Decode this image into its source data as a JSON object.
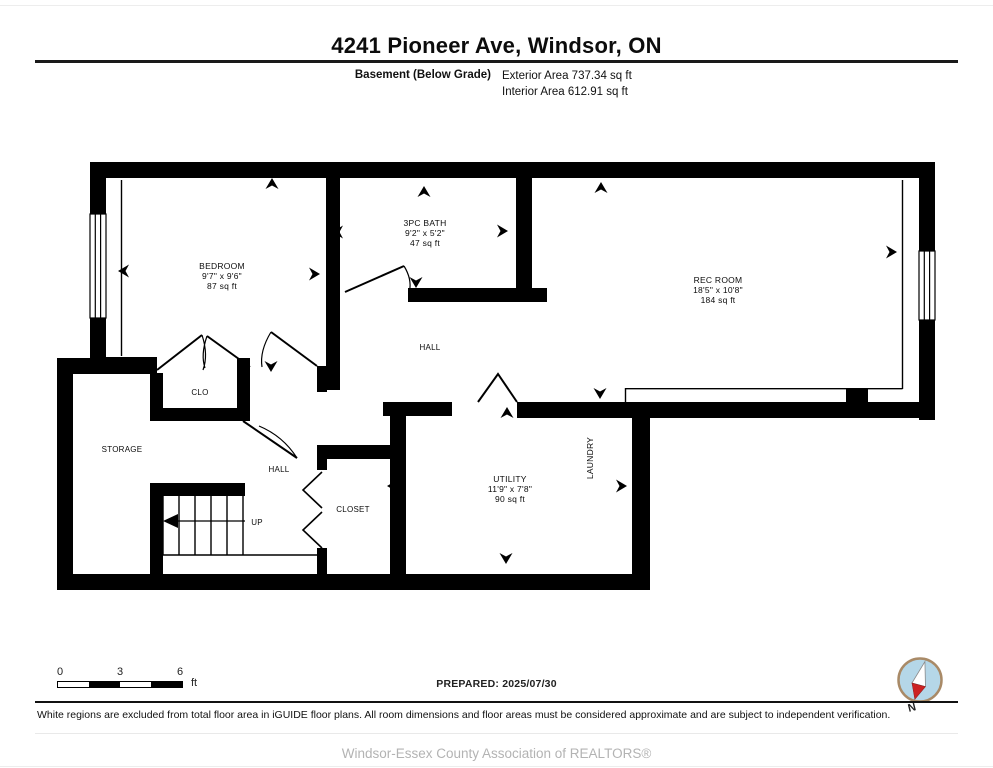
{
  "header": {
    "title": "4241 Pioneer Ave, Windsor, ON",
    "floor": "Basement (Below Grade)",
    "exterior_area": "Exterior Area 737.34 sq ft",
    "interior_area": "Interior Area 612.91 sq ft"
  },
  "rooms": {
    "bedroom": {
      "name": "BEDROOM",
      "dims": "9'7\" x 9'6\"",
      "area": "87 sq ft"
    },
    "bath": {
      "name": "3PC BATH",
      "dims": "9'2\" x 5'2\"",
      "area": "47 sq ft"
    },
    "rec": {
      "name": "REC ROOM",
      "dims": "18'5\" x 10'8\"",
      "area": "184 sq ft"
    },
    "utility": {
      "name": "UTILITY",
      "dims": "11'9\" x 7'8\"",
      "area": "90 sq ft"
    },
    "hall_upper": "HALL",
    "hall_lower": "HALL",
    "clo": "CLO",
    "storage": "STORAGE",
    "closet": "CLOSET",
    "laundry": "LAUNDRY",
    "up": "UP"
  },
  "scale": {
    "t0": "0",
    "t3": "3",
    "t6": "6",
    "unit": "ft"
  },
  "prepared": "PREPARED: 2025/07/30",
  "compass": {
    "n": "N"
  },
  "disclaimer": "White regions are excluded from total floor area in iGUIDE floor plans. All room dimensions and floor areas must be considered approximate and are subject to independent verification.",
  "footer": "Windsor-Essex County Association of REALTORS®",
  "colors": {
    "wall": "#000000",
    "compass_fill": "#b5d7e8",
    "compass_ring": "#a98a67",
    "needle_red": "#cc2222",
    "footer_gray": "#b3b3b3"
  }
}
